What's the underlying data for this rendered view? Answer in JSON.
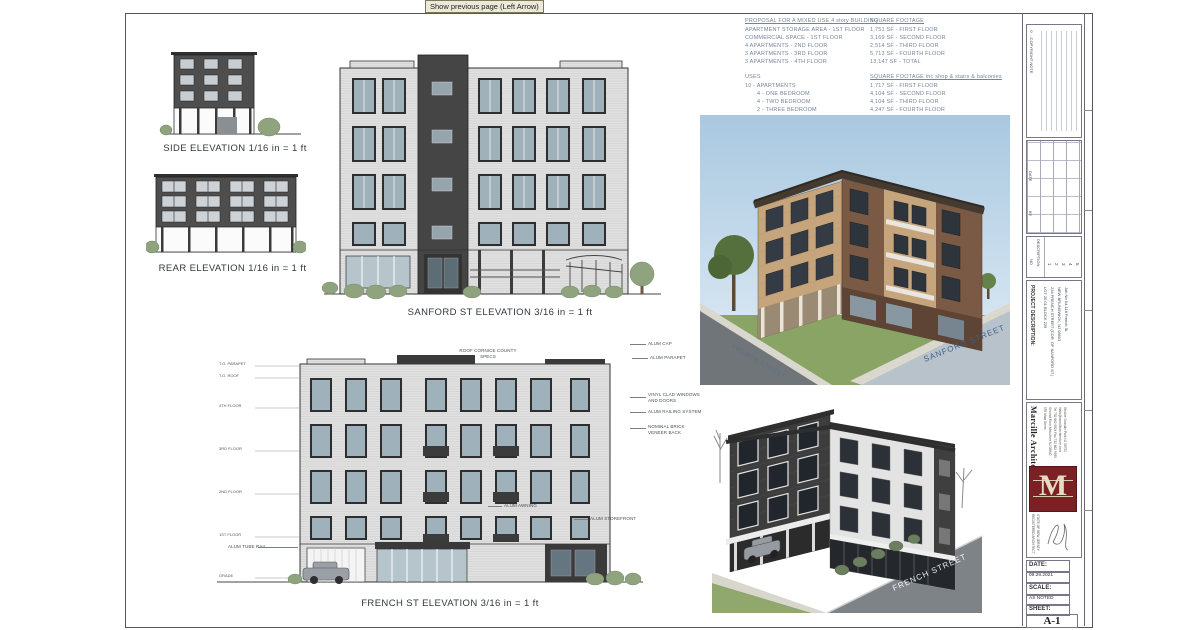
{
  "viewer": {
    "tooltip": "Show previous page (Left Arrow)"
  },
  "notes": {
    "proposal": {
      "title": "PROPOSAL FOR A MIXED USE 4 story BUILDING",
      "lines": [
        "APARTMENT STORAGE AREA - 1ST FLOOR",
        "COMMERCIAL SPACE - 1ST FLOOR",
        "4 APARTMENTS - 2ND FLOOR",
        "3 APARTMENTS - 3RD FLOOR",
        "3 APARTMENTS - 4TH FLOOR"
      ]
    },
    "uses": {
      "title": "USES",
      "lines": [
        "10 - APARTMENTS",
        "4 - ONE BEDROOM",
        "4 - TWO BEDROOM",
        "2 - THREE BEDROOM",
        "COMMERCIAL SPACE - 402 SF TOTAL"
      ]
    },
    "sqft": {
      "title": "SQUARE FOOTAGE",
      "lines": [
        "1,751 SF - FIRST FLOOR",
        "3,169 SF - SECOND FLOOR",
        "2,514 SF - THIRD FLOOR",
        "5,713 SF - FOURTH FLOOR",
        "13,147 SF - TOTAL"
      ]
    },
    "sqft_inc": {
      "title": "SQUARE FOOTAGE inc shop & stairs & balconies",
      "lines": [
        "1,717 SF - FIRST FLOOR",
        "4,104 SF - SECOND FLOOR",
        "4,104 SF - THIRD FLOOR",
        "4,247 SF - FOURTH FLOOR",
        "14,172 SF - TOTAL"
      ]
    }
  },
  "elevations": {
    "side": {
      "label": "SIDE ELEVATION 1/16 in = 1 ft"
    },
    "rear": {
      "label": "REAR ELEVATION 1/16 in = 1 ft"
    },
    "sanford": {
      "label": "SANFORD ST ELEVATION 3/16 in = 1 ft"
    },
    "french": {
      "label": "FRENCH ST ELEVATION 3/16 in = 1 ft",
      "levels": [
        "T.O. PARAPET",
        "T.O. ROOF",
        "4TH FLOOR",
        "3RD FLOOR",
        "2ND FLOOR",
        "1ST FLOOR",
        "GRADE"
      ],
      "annotations": {
        "roof_cornice": "ROOF CORNICE COUNTY SPECS",
        "alum_cap": "ALUM CAP",
        "alum_parapet": "ALUM PARAPET",
        "vinyl_windows": "VINYL CLAD WINDOWS AND DOORS",
        "railing": "ALUM RAILING SYSTEM",
        "brick_veneer": "NOMINAL BRICK VENEER BACK",
        "awning": "ALUM AWNING",
        "storefront": "ALUM STOREFRONT",
        "tube_rail": "ALUM TUBE RAIL"
      }
    }
  },
  "renderings": {
    "sanford_street": "SANFORD STREET",
    "french_street": "FRENCH STREET"
  },
  "titleblock": {
    "copyright_note": "© - COPYRIGHT NOTE",
    "revisions": {
      "date": "DATE",
      "by": "BY",
      "no": "NO",
      "description": "DESCRIPTION",
      "rows": [
        "1",
        "2",
        "3",
        "4",
        "5"
      ]
    },
    "project": {
      "heading": "PROJECT DESCRIPTION:",
      "lines": [
        "LOT 20.01 BLOCK 229",
        "234 FRENCH STREET (COR. OF SANFORD ST.)",
        "NEW BRUNSWICK, NJ 08903",
        "Job No 04-116 French St"
      ]
    },
    "firm": {
      "name": "Marcille Architecture",
      "logo_letter": "M",
      "address": [
        "555 Main Street",
        "Second Floor Metuchen NJ 08840",
        "Tel 732 662 0824  Fax 732 662 9935",
        "mark@marcillearchitecture.com",
        "9th Ave Seaside Park NJ 08752"
      ],
      "registered": [
        "REGISTERED ARCHITECT",
        "STATE OF NEW JERSEY"
      ]
    },
    "date": {
      "label": "DATE:",
      "value": "09.28.2021"
    },
    "scale": {
      "label": "SCALE:",
      "value": "AS NOTED"
    },
    "sheet": {
      "label": "SHEET:",
      "value": "A-1"
    }
  },
  "colors": {
    "logo_maroon": "#7b2024",
    "sky_blue": "#a9c8e0",
    "street_label_blue": "#3e5f85",
    "note_text": "#76849b"
  }
}
